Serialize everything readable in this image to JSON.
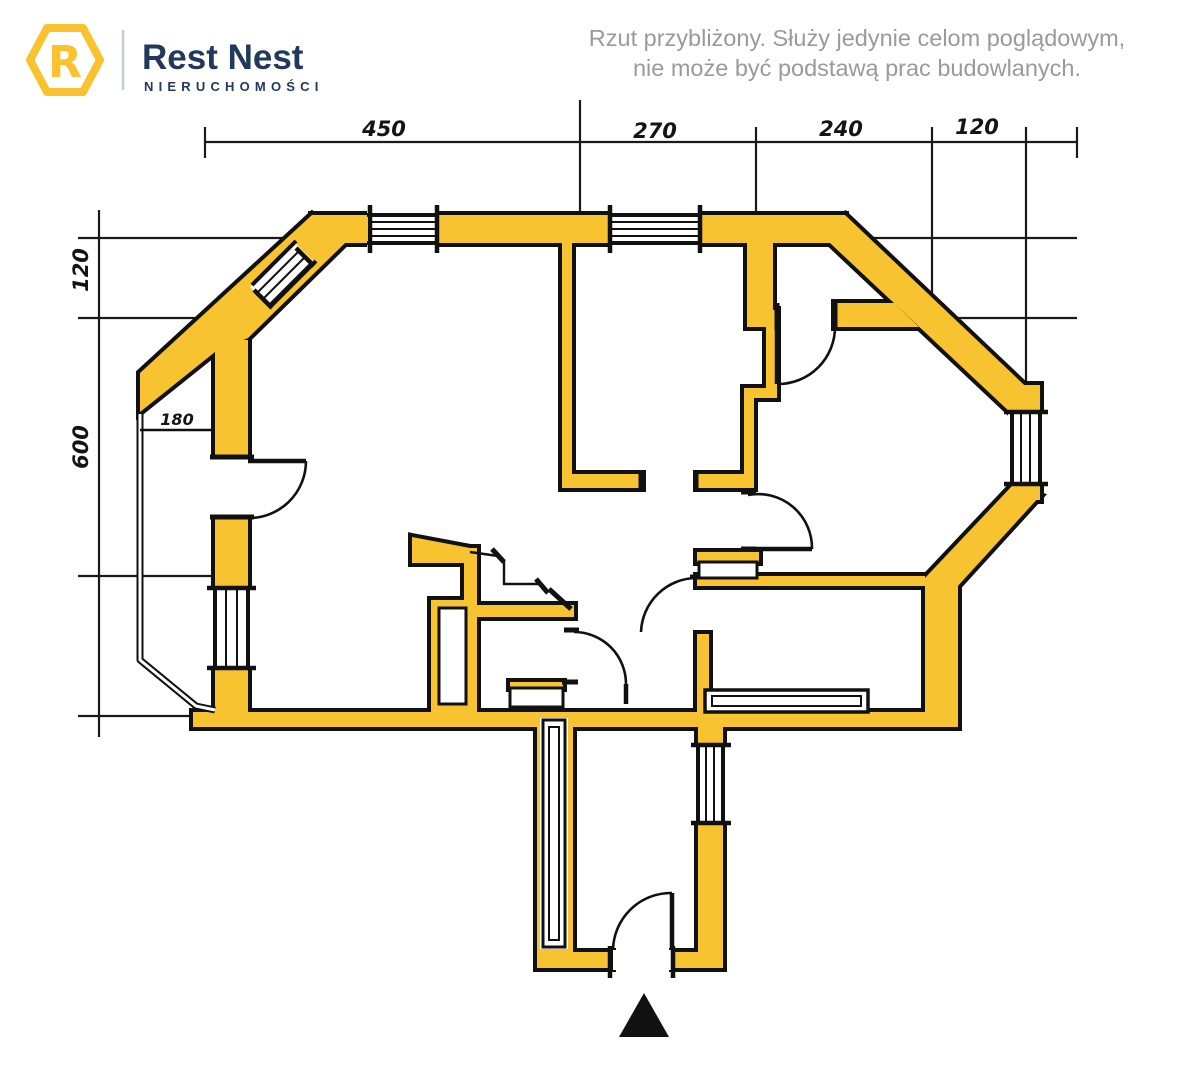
{
  "header": {
    "logo": {
      "letter": "R",
      "brand": "Rest Nest",
      "subtitle": "NIERUCHOMOŚCI"
    },
    "disclaimer": {
      "line1": "Rzut przybliżony. Służy jedynie celom poglądowym,",
      "line2": "nie może być podstawą prac budowlanych."
    }
  },
  "plan": {
    "dimensions": {
      "top": [
        "450",
        "270",
        "240",
        "120"
      ],
      "left": [
        "120",
        "600"
      ],
      "interior": [
        "180"
      ]
    }
  },
  "colors": {
    "wall_yellow": "#F7C331",
    "outline_black": "#111111",
    "line_black": "#1A1A1A",
    "logo_yellow": "#F9C22E",
    "brand_navy": "#21395D",
    "disclaimer_gray": "#9A9A9A"
  }
}
